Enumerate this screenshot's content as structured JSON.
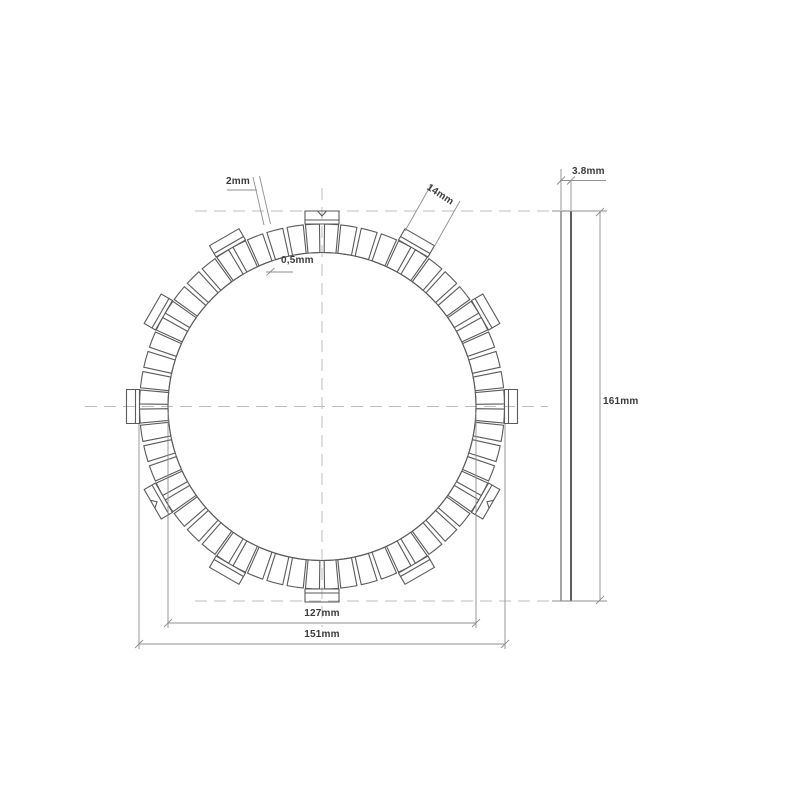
{
  "drawing": {
    "colors": {
      "background": "#ffffff",
      "geometry_line": "#5a5a5a",
      "centerline": "#bcbcbc",
      "dimension_line": "#8f8f8f",
      "label_text": "#3b3b3b"
    },
    "front_view": {
      "center": {
        "x": 322,
        "y": 406.5
      },
      "radii": {
        "pad_inner": 154,
        "pad_outer": 182.5,
        "tab_outer": 195.5,
        "tab_step": 186.5
      },
      "tab_count": 12,
      "tab_step_deg": 30,
      "first_tab_angle_deg": -90,
      "tab_pad_half_deg": 5.2,
      "tab_rect_half_width_px": 17,
      "pads_between_tabs": 3,
      "pad_gap_deg": 0.7,
      "notch_tab_angles_deg": [
        -90,
        30,
        150
      ]
    },
    "side_view": {
      "left": 561,
      "right": 571,
      "top": 211,
      "bottom": 601
    },
    "labels": {
      "slit_width": "2mm",
      "tab_width": "14mm",
      "pad_chamfer": "0,5mm",
      "thickness": "3.8mm",
      "overall_diameter": "161mm",
      "friction_inner_diameter": "127mm",
      "friction_outer_diameter": "151mm"
    }
  }
}
